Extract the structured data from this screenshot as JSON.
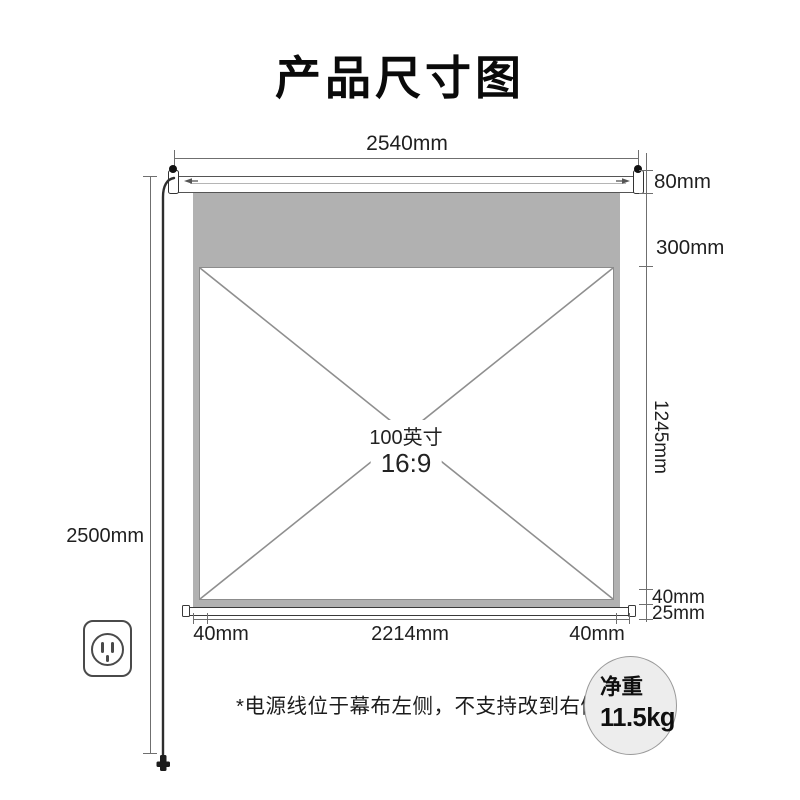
{
  "title": "产品尺寸图",
  "dimensions": {
    "top_width": "2540mm",
    "total_height": "2500mm",
    "case_height": "80mm",
    "top_black_border": "300mm",
    "viewing_height": "1245mm",
    "bottom_black_border": "40mm",
    "bottom_bar": "25mm",
    "side_border_left": "40mm",
    "viewing_width": "2214mm",
    "side_border_right": "40mm"
  },
  "screen_area": {
    "size": "100英寸",
    "aspect_ratio": "16:9"
  },
  "footnote": "*电源线位于幕布左侧，不支持改到右侧",
  "weight_badge": {
    "label": "净重",
    "value": "11.5kg"
  },
  "icons": {
    "power_outlet": "wall-outlet-icon",
    "power_cord": "power-cord-with-plug",
    "mount_bracket": "hanging-bracket"
  },
  "colors": {
    "black_border_fill": "#b1b1b1",
    "dimension_line": "#6f6f6f",
    "diagonal_line": "#8f8f8f",
    "text": "#1f1f1f",
    "badge_fill": "#ededed",
    "badge_border": "#9a9a9a"
  }
}
